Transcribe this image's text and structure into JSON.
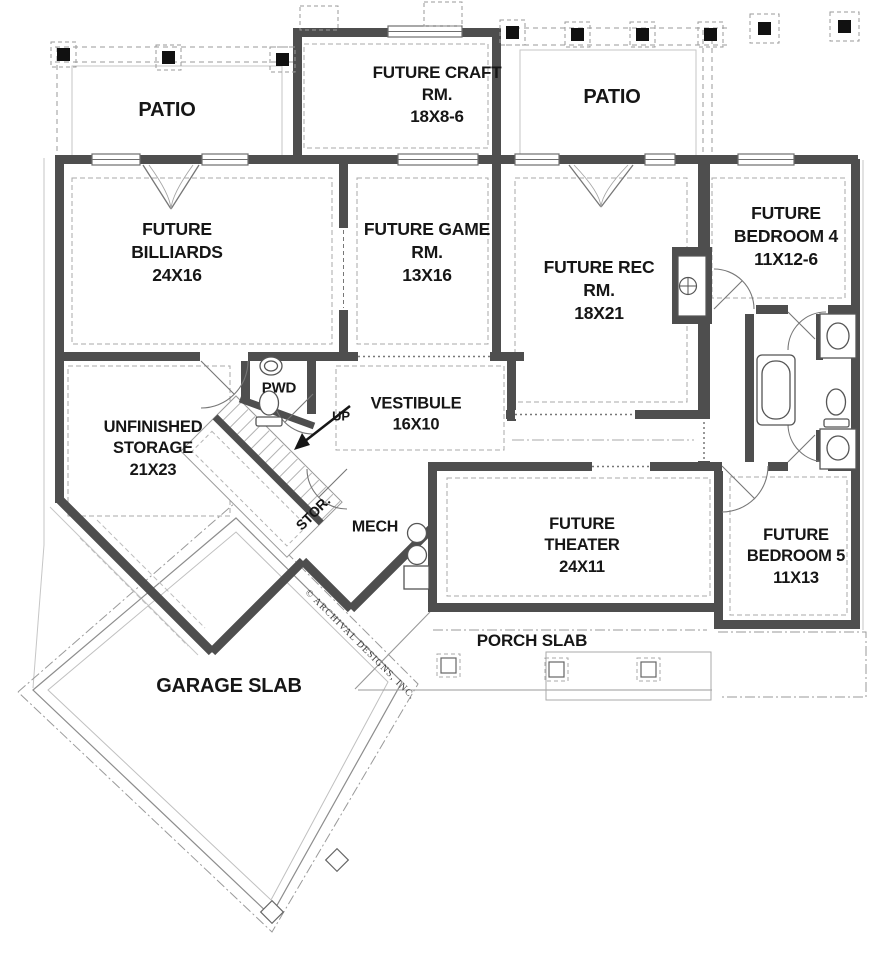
{
  "plan": {
    "watermark": "© ARCHIVAL DESIGNS, INC.",
    "wall_color": "#4e4e4e",
    "line_color": "#9a9a9a",
    "rooms": [
      {
        "id": "patio-left",
        "label": "PATIO"
      },
      {
        "id": "future-craft-room",
        "label": "FUTURE CRAFT RM.",
        "dims": "18X8-6"
      },
      {
        "id": "patio-right",
        "label": "PATIO"
      },
      {
        "id": "future-billiards",
        "label": "FUTURE BILLIARDS",
        "dims": "24X16"
      },
      {
        "id": "future-game-room",
        "label": "FUTURE GAME RM.",
        "dims": "13X16"
      },
      {
        "id": "future-rec-room",
        "label": "FUTURE REC RM.",
        "dims": "18X21"
      },
      {
        "id": "future-bedroom-4",
        "label": "FUTURE BEDROOM 4",
        "dims": "11X12-6"
      },
      {
        "id": "unfinished-storage",
        "label": "UNFINISHED STORAGE",
        "dims": "21X23"
      },
      {
        "id": "powder-room",
        "label": "PWD"
      },
      {
        "id": "vestibule",
        "label": "VESTIBULE",
        "dims": "16X10"
      },
      {
        "id": "stair-direction",
        "label": "UP"
      },
      {
        "id": "stair-storage",
        "label": "STOR."
      },
      {
        "id": "mechanical-room",
        "label": "MECH"
      },
      {
        "id": "future-theater",
        "label": "FUTURE THEATER",
        "dims": "24X11"
      },
      {
        "id": "future-bedroom-5",
        "label": "FUTURE BEDROOM 5",
        "dims": "11X13"
      },
      {
        "id": "porch-slab",
        "label": "PORCH SLAB"
      },
      {
        "id": "garage-slab",
        "label": "GARAGE SLAB"
      }
    ]
  }
}
